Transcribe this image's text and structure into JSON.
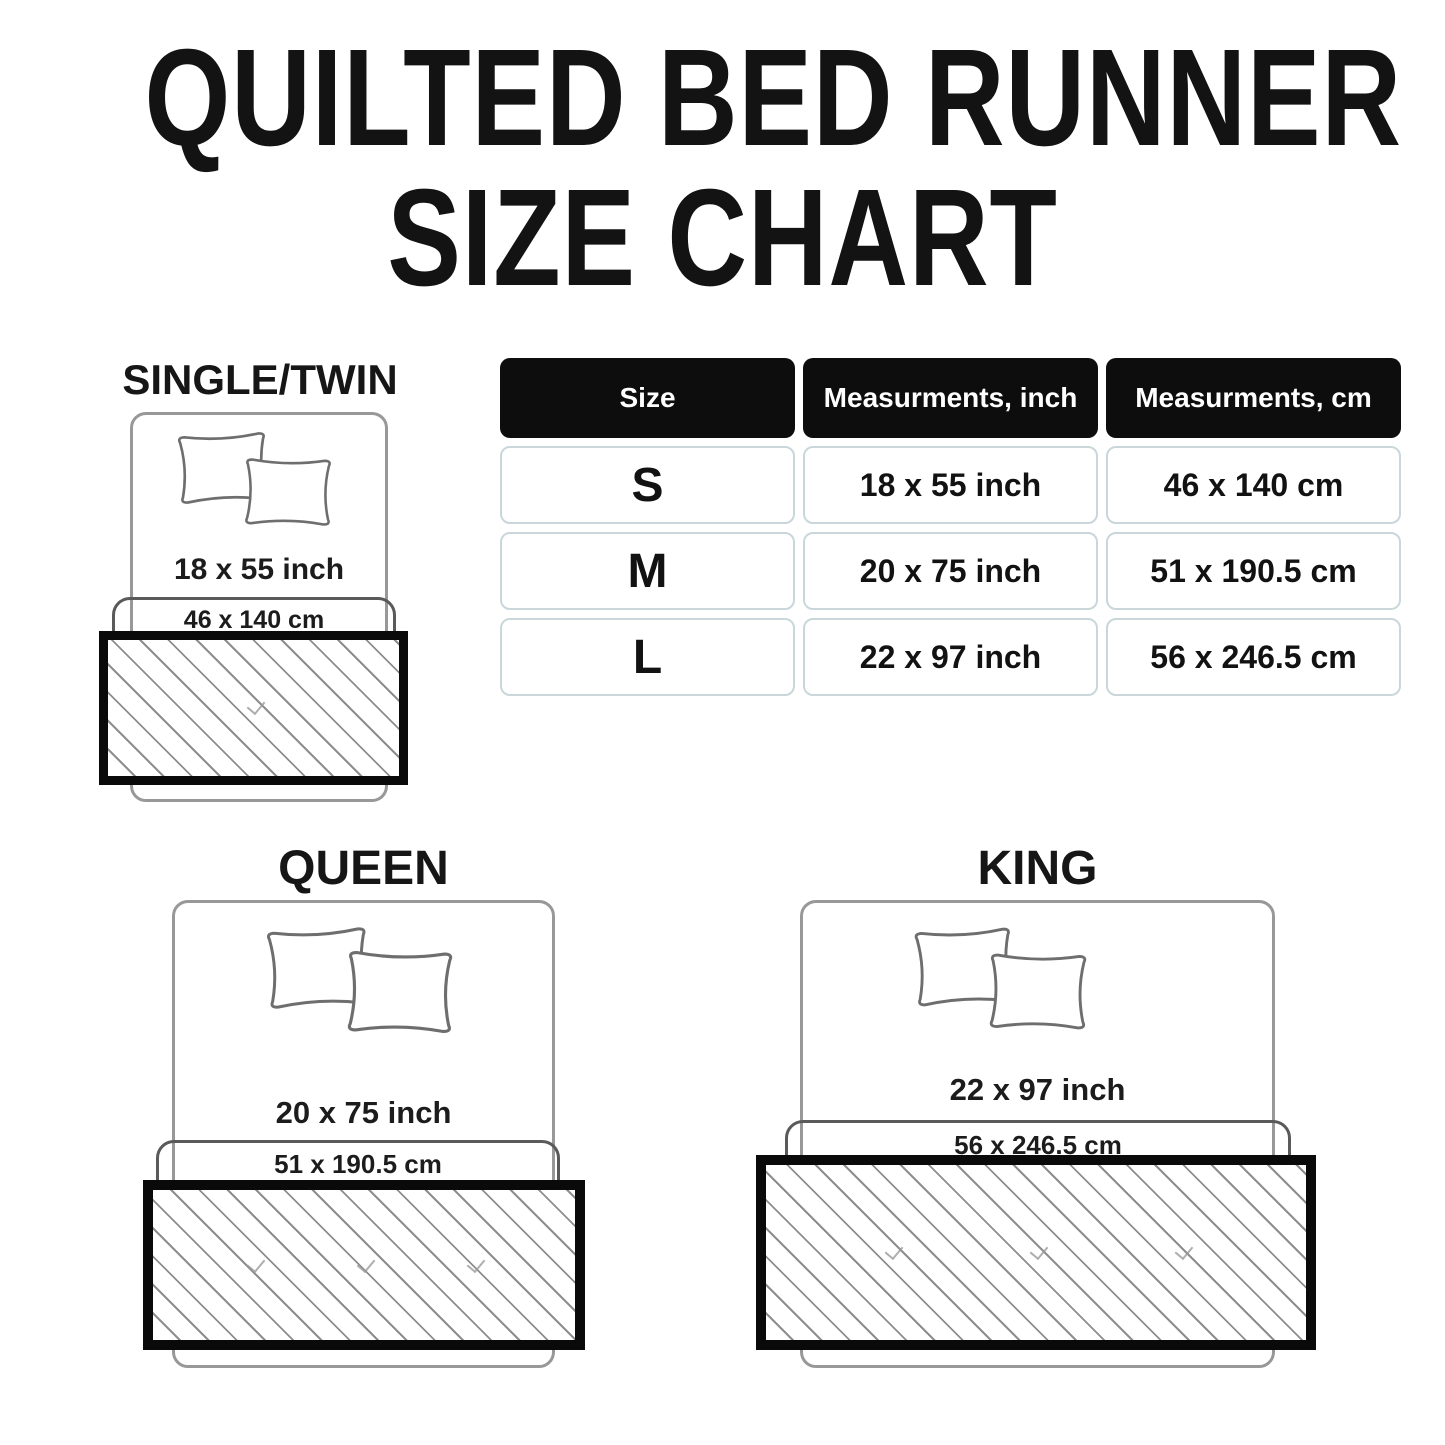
{
  "title": {
    "line1": "QUILTED BED RUNNER",
    "line2": "SIZE CHART"
  },
  "table": {
    "headers": [
      "Size",
      "Measurments, inch",
      "Measurments, cm"
    ],
    "rows": [
      {
        "size": "S",
        "inch": "18 x 55 inch",
        "cm": "46 x 140 cm"
      },
      {
        "size": "M",
        "inch": "20 x 75 inch",
        "cm": "51 x 190.5 cm"
      },
      {
        "size": "L",
        "inch": "22 x 97 inch",
        "cm": "56 x 246.5 cm"
      }
    ]
  },
  "diagrams": {
    "single": {
      "label": "SINGLE/TWIN",
      "inch": "18 x 55 inch",
      "cm": "46 x 140 cm"
    },
    "queen": {
      "label": "QUEEN",
      "inch": "20 x 75 inch",
      "cm": "51 x 190.5 cm"
    },
    "king": {
      "label": "KING",
      "inch": "22 x 97 inch",
      "cm": "56 x 246.5 cm"
    }
  },
  "colors": {
    "text": "#141414",
    "table_header_bg": "#0d0d0d",
    "table_header_text": "#ffffff",
    "table_cell_border": "#c9d7da",
    "bed_outline": "#989898",
    "band_outline": "#5a5a5a",
    "runner_border": "#0a0a0a",
    "hatch_line": "#8e8e8e"
  }
}
